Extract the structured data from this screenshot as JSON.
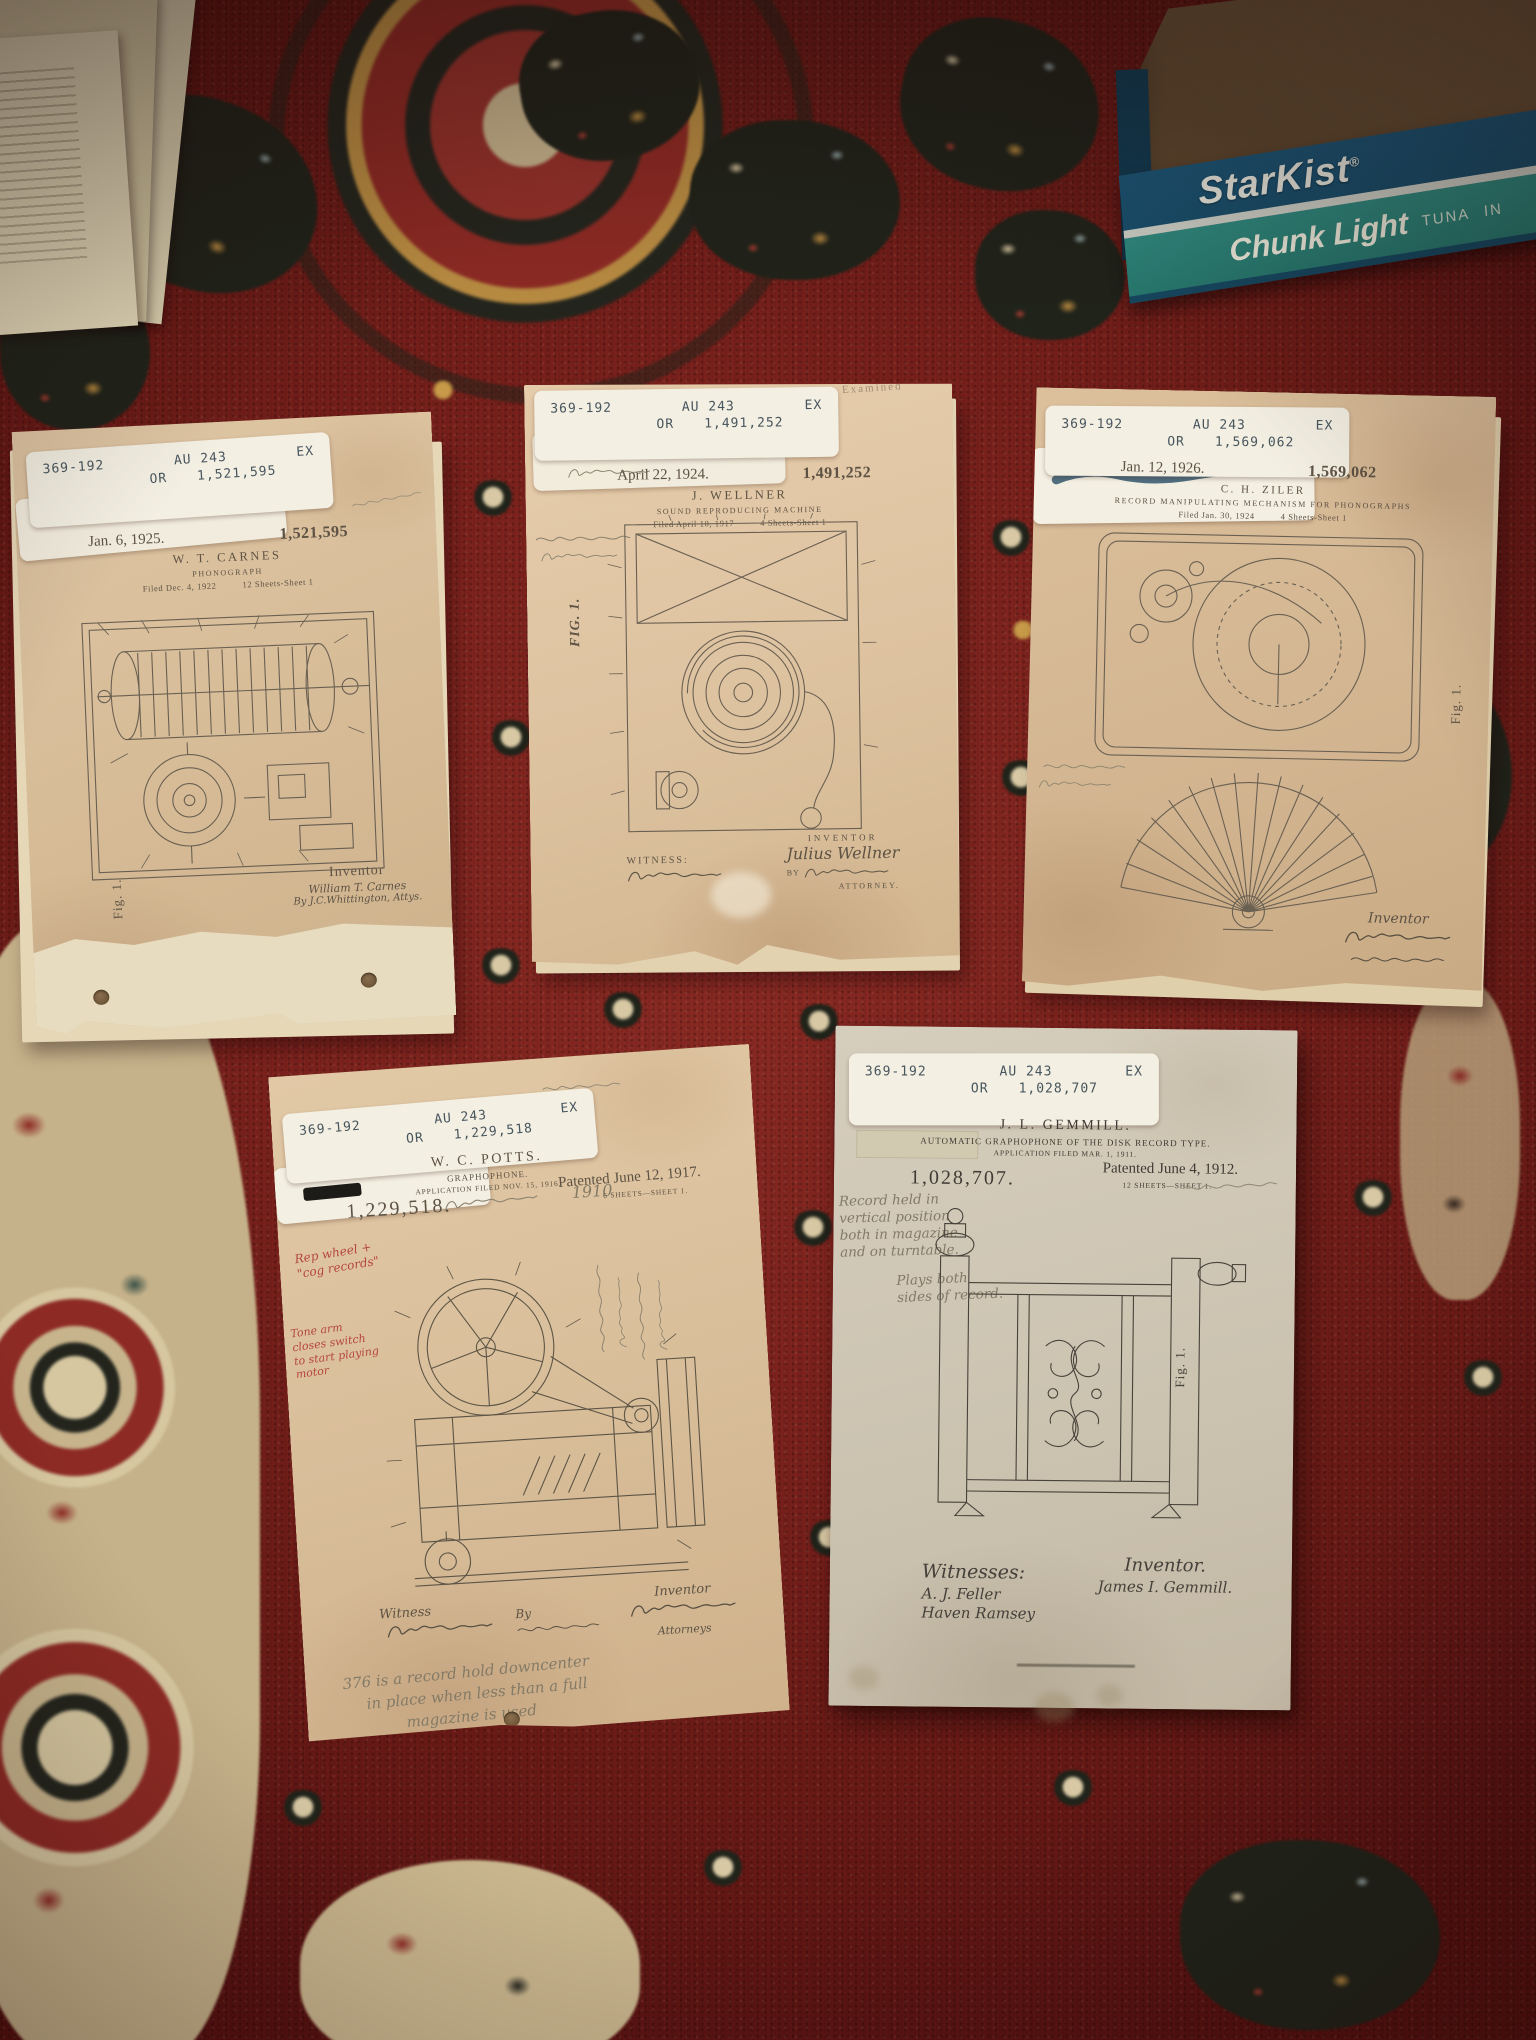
{
  "colors": {
    "rug_red": "#7c221d",
    "starkist_blue": "#17506e",
    "starkist_teal": "#2f8d82",
    "paper_tan": "#ddc3a0"
  },
  "starkist_box": {
    "brand": "StarKist",
    "trademark": "®",
    "product_line": "Chunk Light",
    "product_sub": "TUNA",
    "product_sub2": "IN"
  },
  "documents": [
    {
      "label": {
        "code": "369-192",
        "au": "AU 243",
        "ex": "EX",
        "or": "OR",
        "number": "1,521,595"
      },
      "header": {
        "date": "Jan. 6, 1925.",
        "inventor": "W. T. CARNES",
        "number": "1,521,595",
        "title": "PHONOGRAPH",
        "filed": "Filed Dec. 4, 1922",
        "sheet": "12 Sheets-Sheet 1"
      },
      "figure_label": "Fig. 1.",
      "footer": {
        "inventor_label": "Inventor",
        "inventor_name": "William T. Carnes",
        "attorney_line": "By J.C.Whittington, Attys."
      }
    },
    {
      "label": {
        "code": "369-192",
        "au": "AU 243",
        "ex": "EX",
        "or": "OR",
        "number": "1,491,252"
      },
      "stamp": "Examined",
      "header": {
        "date": "April 22, 1924.",
        "inventor": "J. WELLNER",
        "number": "1,491,252",
        "title": "SOUND REPRODUCING MACHINE",
        "filed": "Filed April 10, 1917",
        "sheet": "4 Sheets-Sheet 1"
      },
      "figure_label": "FIG. 1.",
      "footer": {
        "witness_label": "WITNESS:",
        "inventor_label": "INVENTOR",
        "inventor_name": "Julius Wellner",
        "by_label": "BY",
        "attorney_label": "ATTORNEY."
      }
    },
    {
      "label": {
        "code": "369-192",
        "au": "AU 243",
        "ex": "EX",
        "or": "OR",
        "number": "1,569,062"
      },
      "header": {
        "date": "Jan. 12, 1926.",
        "inventor": "C. H. ZILER",
        "number": "1,569,062",
        "title": "RECORD MANIPULATING MECHANISM FOR PHONOGRAPHS",
        "filed": "Filed Jan. 30, 1924",
        "sheet": "4 Sheets-Sheet 1"
      },
      "figure_label": "Fig. 1.",
      "footer": {
        "inventor_label": "Inventor"
      }
    },
    {
      "label": {
        "code": "369-192",
        "au": "AU 243",
        "ex": "EX",
        "or": "OR",
        "number": "1,229,518"
      },
      "header": {
        "inventor": "W. C. POTTS.",
        "title": "GRAPHOPHONE.",
        "application": "APPLICATION FILED NOV. 15, 1916.",
        "patented": "Patented June 12, 1917.",
        "sheet": "6 SHEETS—SHEET 1.",
        "number": "1,229,518."
      },
      "annotations": {
        "pencil_year": "1910",
        "red_note_1": [
          "Rep wheel +",
          "\"cog records\""
        ],
        "red_note_2": [
          "Tone arm",
          "closes switch",
          "to start playing",
          "motor"
        ],
        "pencil_bottom": [
          "376 is a record hold downcenter",
          "in place when less than a full",
          "magazine is used"
        ]
      },
      "footer": {
        "witness_label": "Witness",
        "by_label": "By",
        "inventor_label": "Inventor",
        "attorneys_label": "Attorneys"
      }
    },
    {
      "label": {
        "code": "369-192",
        "au": "AU 243",
        "ex": "EX",
        "or": "OR",
        "number": "1,028,707"
      },
      "header": {
        "inventor": "J. L. GEMMILL.",
        "title": "AUTOMATIC GRAPHOPHONE OF THE DISK RECORD TYPE.",
        "application": "APPLICATION FILED MAR. 1, 1911.",
        "patented": "Patented June 4, 1912.",
        "sheet": "12 SHEETS—SHEET 1.",
        "number": "1,028,707."
      },
      "figure_label": "Fig. 1.",
      "annotations": {
        "pencil_note_1": [
          "Record held in",
          "vertical position",
          "both in magazine",
          "and on turntable."
        ],
        "pencil_note_2": [
          "Plays both",
          "sides of record."
        ]
      },
      "footer": {
        "witnesses_label": "Witnesses:",
        "witness_1": "A. J. Feller",
        "witness_2": "Haven Ramsey",
        "inventor_label": "Inventor.",
        "inventor_name": "James I. Gemmill."
      }
    }
  ]
}
